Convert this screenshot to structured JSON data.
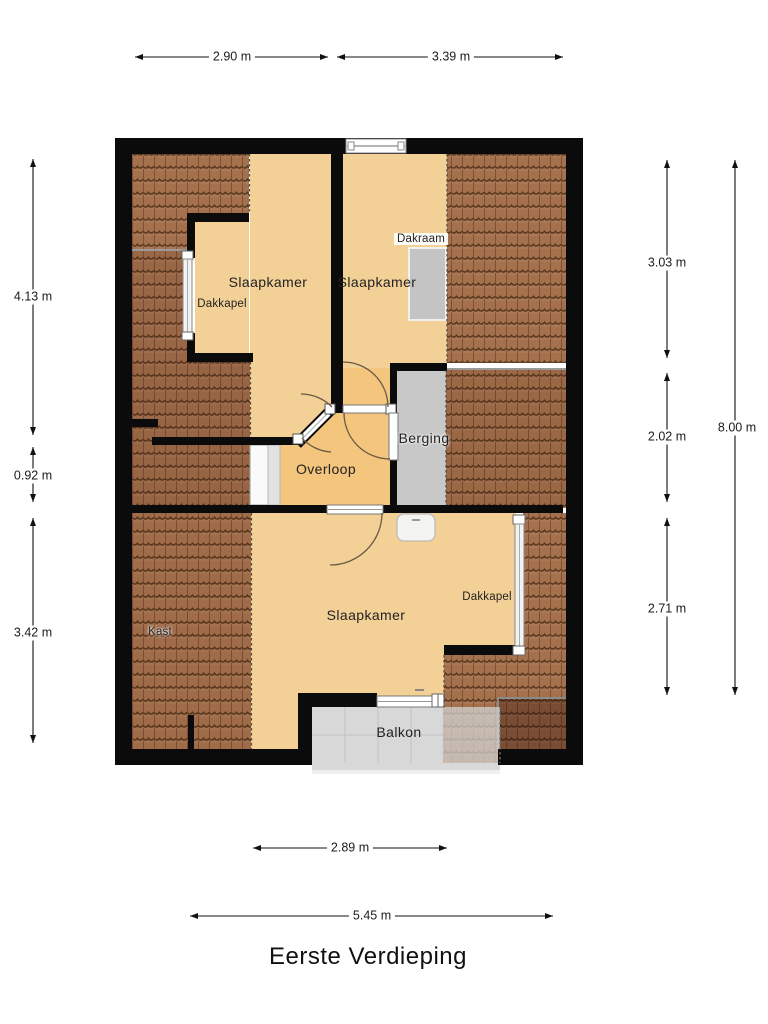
{
  "title": "Eerste Verdieping",
  "floorplan": {
    "rooms": [
      {
        "name": "Slaapkamer"
      },
      {
        "name": "Slaapkamer"
      },
      {
        "name": "Slaapkamer"
      },
      {
        "name": "Overloop"
      },
      {
        "name": "Berging"
      },
      {
        "name": "Balkon"
      },
      {
        "name": "Kast"
      }
    ],
    "features": [
      {
        "name": "Dakkapel"
      },
      {
        "name": "Dakraam"
      },
      {
        "name": "Dakkapel"
      }
    ],
    "dimensions": {
      "top": [
        {
          "value": "2.90 m"
        },
        {
          "value": "3.39 m"
        }
      ],
      "left": [
        {
          "value": "4.13 m"
        },
        {
          "value": "0.92 m"
        },
        {
          "value": "3.42 m"
        }
      ],
      "right": [
        {
          "value": "3.03 m"
        },
        {
          "value": "2.02 m"
        },
        {
          "value": "2.71 m"
        }
      ],
      "right_total": {
        "value": "8.00 m"
      },
      "bottom": [
        {
          "value": "2.89 m"
        },
        {
          "value": "5.45 m"
        }
      ]
    },
    "colors": {
      "wall": "#0b0b0b",
      "bedroom_floor": "#f2d096",
      "hall_floor": "#f4c57c",
      "storage_floor": "#c8c8c8",
      "balcony_floor": "#d8d8d8",
      "roof_tiles": "#a5714d",
      "dimension_text": "#1b1b1b"
    }
  }
}
